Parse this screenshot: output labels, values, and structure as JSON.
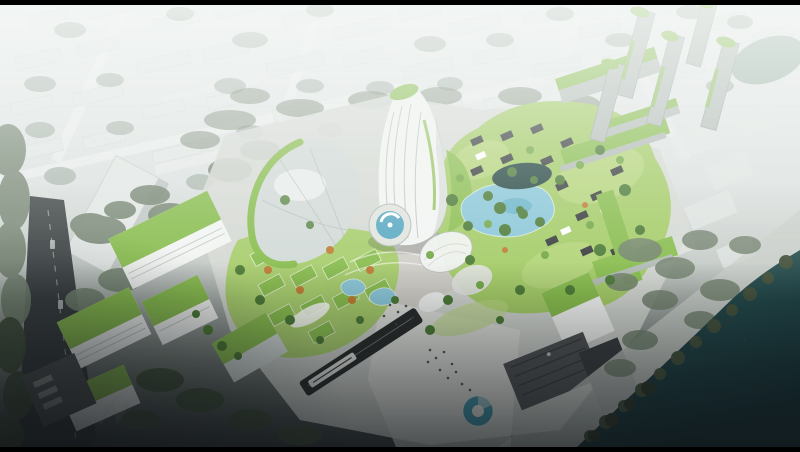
{
  "scene": {
    "type": "aerial-architectural-rendering",
    "description": "Bird's-eye rendering of a green mixed-use riverfront masterplan: a curved white sail tower with vertical fins, a leaf-shaped glass canopy, clusters of green-roofed low-rise blocks and white offices with sloped green roofs, a lagoon pool, plazas with blue water features, a sunken transit line with a train, slender green-capped towers at upper right, all set in a hazy pale city grid with a tree-lined promenade and dark teal river across the lower right; thin black letterbox bars at top and bottom.",
    "landmarks": [
      "hazy-city-context",
      "curved-sail-tower",
      "leaf-shaped-canopy",
      "green-roof-village",
      "green-roof-offices",
      "lagoon-pool",
      "dark-pond",
      "circular-fountain",
      "dome-canopies",
      "kidney-pools",
      "donut-fountain-plaza",
      "transit-trench-train",
      "slender-green-cap-towers",
      "dark-existing-buildings",
      "riverfront-promenade",
      "river",
      "left-road",
      "letterbox-bars"
    ],
    "palette": {
      "letterbox": "#000000",
      "haze_top": "#e9edec",
      "haze_mid": "#dee3e1",
      "ground_mid": "#c6ccc8",
      "ground_low": "#7b837e",
      "vignette": "#121619",
      "white_haze": "#f5f8f6",
      "far_block": "#e3e8e6",
      "far_block_shade": "#c7cfcb",
      "far_tree": "#a8b4ab",
      "far_road": "#eef1f0",
      "context_tree": "#72816e",
      "shore_tree": "#41503a",
      "shore_tree_dark": "#2a352a",
      "pond_far": "#92ab9d",
      "water_top": "#2e5c5b",
      "water_deep": "#112b30",
      "promenade": "#c9cec9",
      "pavement": "#d6d9d4",
      "pavement_warm": "#cbc1b8",
      "plaza_light": "#e2e4df",
      "road_dark": "#2f3436",
      "road_line": "#c8cdc9",
      "green_roof": "#88bd4d",
      "green_lawn": "#a4cc66",
      "green_bright": "#bcd982",
      "tree_green": "#4b7a35",
      "tree_light": "#72a746",
      "tree_autumn": "#bf7c33",
      "white_bldg": "#f3f5f3",
      "facade_shade": "#b2bbb6",
      "glass": "#d2dad7",
      "glass_dark": "#9dabaa",
      "tower_grey": "#b5beb9",
      "tower_shade": "#939e98",
      "dark_bldg": "#4e5052",
      "dark_roof": "#383b3d",
      "train_dark": "#262a2a",
      "pool_blue": "#8ac7d9",
      "pool_deep": "#57a8c2",
      "pond_dark": "#234440",
      "fountain_teal": "#3c95ab",
      "people": "#383d3d",
      "white": "#ffffff"
    }
  }
}
